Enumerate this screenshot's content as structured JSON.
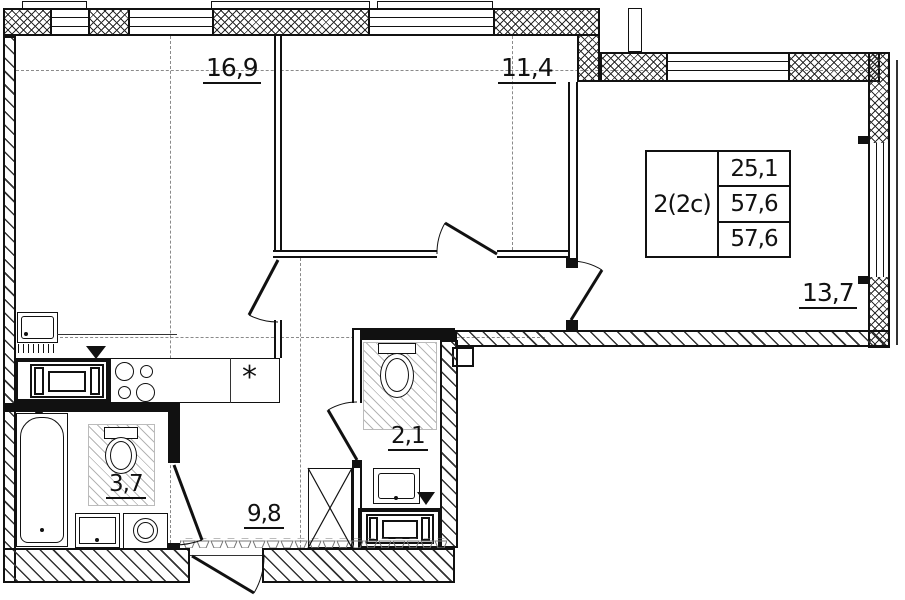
{
  "unit_info": {
    "type": "2(2с)",
    "row1": "25,1",
    "row2": "57,6",
    "row3": "57,6"
  },
  "rooms": {
    "living_kitchen": "16,9",
    "bedroom": "11,4",
    "room": "13,7",
    "bathroom": "3,7",
    "wc": "2,1",
    "hallway": "9,8"
  },
  "symbols": {
    "sink_marker": "*"
  },
  "colors": {
    "line": "#111111",
    "wall_hatch": "#2b2b2b",
    "floor_hatch": "#b5b5b5"
  }
}
